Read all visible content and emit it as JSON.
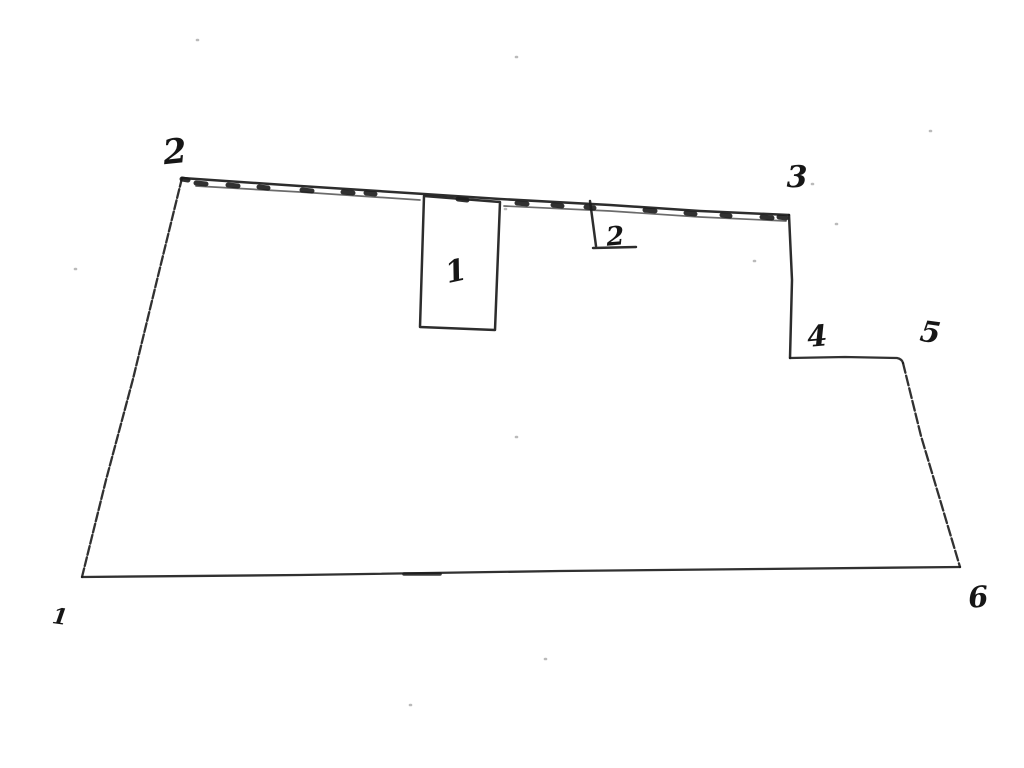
{
  "canvas": {
    "width": 1024,
    "height": 768,
    "background": "#ffffff",
    "ink_color": "#1b1b1b"
  },
  "vertex_labels": [
    {
      "id": "1",
      "text": "1",
      "transform": "translate(59,624) rotate(8)",
      "font_size": "22"
    },
    {
      "id": "2",
      "text": "2",
      "transform": "translate(176,163) rotate(-6)",
      "font_size": "34"
    },
    {
      "id": "3",
      "text": "3",
      "transform": "translate(797,187)",
      "font_size": "30"
    },
    {
      "id": "4",
      "text": "4",
      "transform": "translate(818,346) rotate(-5)",
      "font_size": "29"
    },
    {
      "id": "5",
      "text": "5",
      "transform": "translate(929,342) rotate(8)",
      "font_size": "29"
    },
    {
      "id": "6",
      "text": "6",
      "transform": "translate(979,607) rotate(-5)",
      "font_size": "29"
    }
  ],
  "feature_labels": [
    {
      "id": "building-1",
      "text": "1",
      "transform": "translate(458,281) rotate(-12)",
      "font_size": "30"
    },
    {
      "id": "annex-2",
      "text": "2",
      "transform": "translate(616,245) rotate(-5)",
      "font_size": "26"
    }
  ],
  "paths": {
    "left_edge": "M182 178 L158 276 L133 379 L106 480 L82 577",
    "bottom_edge": "M82 577 L300 575 L560 571 L760 569 L960 567",
    "step_vertical": "M789 215 L792 280 L790 358",
    "step_horizontal": "M790 358 L845 357 L897 358 Q902 359 903 363",
    "right_slant": "M903 363 L921 436 L941 503 L960 567",
    "top_edge_outer": "M182 178 L300 186 L424 194 L500 199 L610 205 L700 211 L789 215",
    "top_edge_inner": "M196 186 L300 192 L420 200 M504 206 L610 211 L700 217 L786 221",
    "hatch_marks": "M182 179 l6 1 M196 183 l10 1 M228 185 l10 1 M259 187 l9 1 M302 190 l10 1 M343 192 l10 1 M366 193 l9 1 M458 199 l9 1 M517 203 l10 1 M553 205 l9 1 M586 207 l8 1 M645 210 l10 1 M686 213 l9 1 M722 215 l8 1 M762 217 l10 1 M779 217 l7 1",
    "building_rect": "M424 196 L500 202 L495 330 L420 327 Z",
    "annex_shape": "M590 201 L596 246 M593 248 L636 247",
    "bottom_emphasis": "M404 574 l36 0",
    "specks": "M197 40 h1 M516 57 h1 M75 269 h1 M754 261 h1 M812 184 h1 M836 224 h1 M505 209 h1 M516 437 h1 M545 659 h1 M410 705 h1 M930 131 h1"
  }
}
